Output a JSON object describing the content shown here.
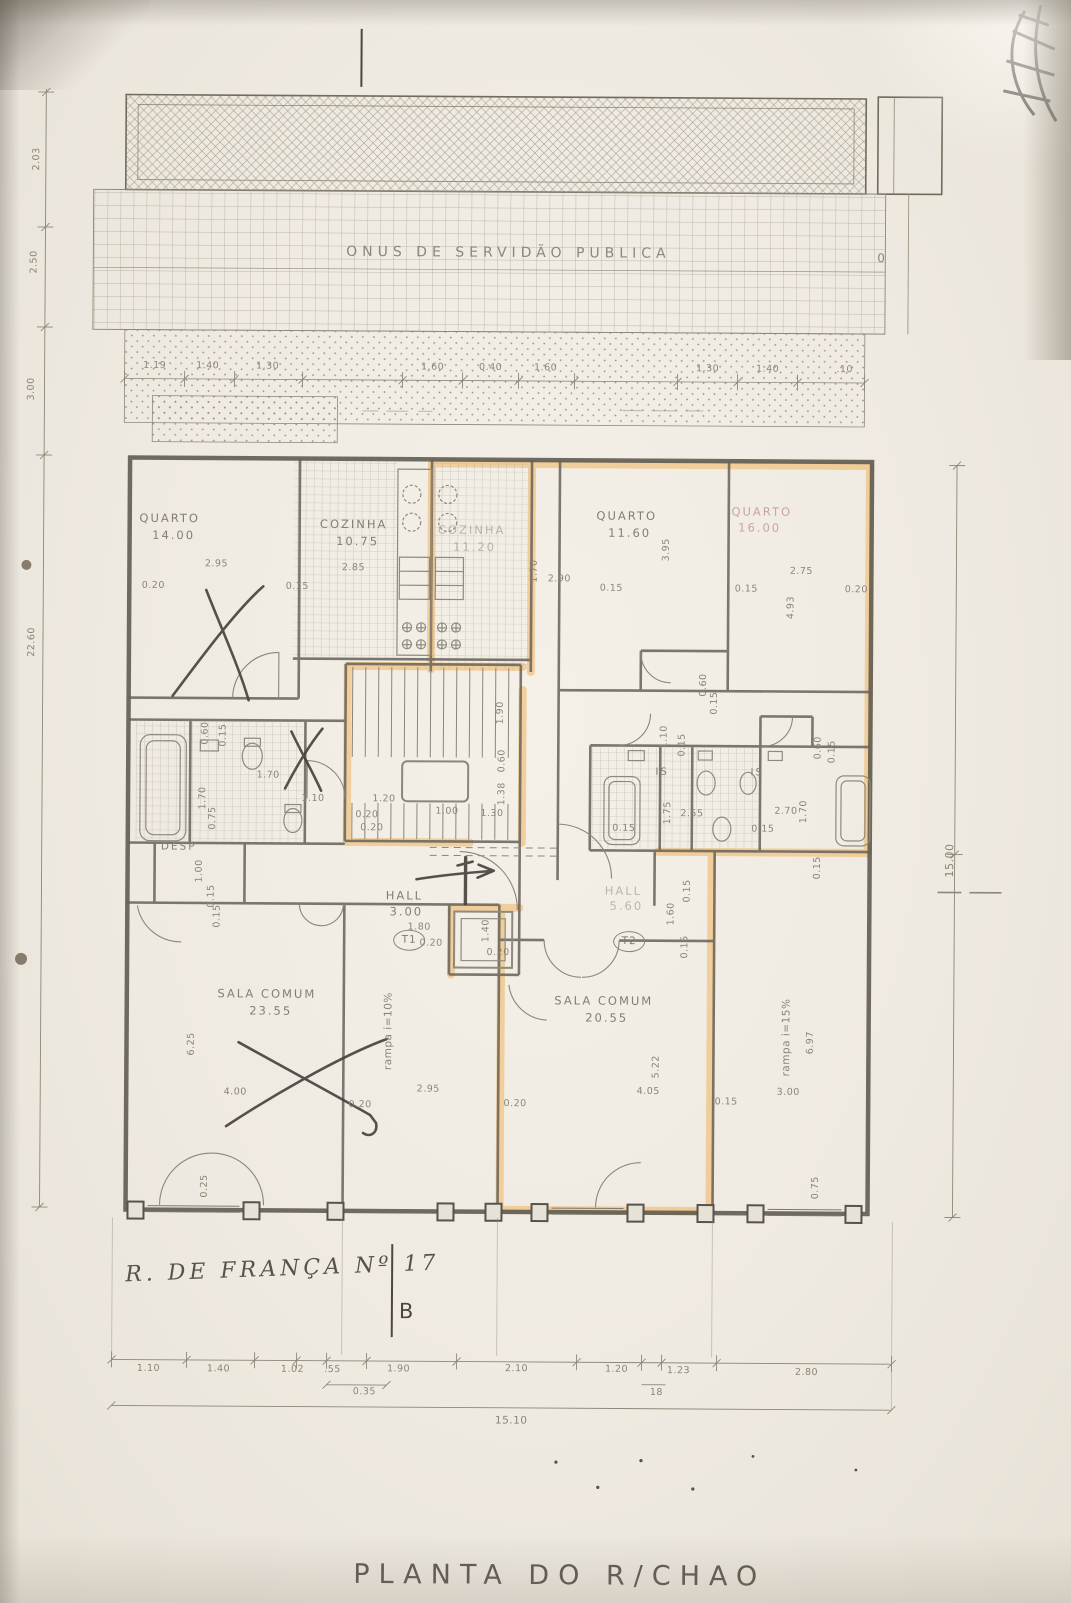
{
  "title": {
    "text": "PLANTA DO R/CHAO"
  },
  "marks": {
    "section": "B",
    "zero": "0",
    "address": "R. DE FRANÇA Nº 17"
  },
  "band": {
    "label": "ONUS DE SERVIDÃO PUBLICA"
  },
  "rooms": {
    "quarto_nw": {
      "name": "QUARTO",
      "area": "14.00"
    },
    "cozinha_1": {
      "name": "COZINHA",
      "area": "10.75"
    },
    "cozinha_2": {
      "name": "COZINHA",
      "area": "11.20"
    },
    "quarto_n": {
      "name": "QUARTO",
      "area": "11.60"
    },
    "quarto_ne": {
      "name": "QUARTO",
      "area": "16.00"
    },
    "desp": {
      "name": "DESP"
    },
    "hall_t1": {
      "name": "HALL",
      "area": "3.00"
    },
    "hall_t2": {
      "name": "HALL",
      "area": "5.60"
    },
    "is_1": {
      "name": "IS"
    },
    "is_2": {
      "name": "IS"
    },
    "sala_t1": {
      "name": "SALA COMUM",
      "area": "23.55"
    },
    "sala_t2": {
      "name": "SALA COMUM",
      "area": "20.55"
    }
  },
  "units": {
    "t1": "T1",
    "t2": "T2"
  },
  "ramps": {
    "left": "rampa  i=10%",
    "right": "rampa  i=15%"
  },
  "dims": {
    "left": [
      "2.03",
      "2.50",
      "3.00",
      "22.60"
    ],
    "right": [
      "15.00"
    ],
    "top": [
      "1.19",
      "1.40",
      "1.30",
      "1.60",
      "0.40",
      "1.60",
      "1.30",
      "1.40",
      ".10"
    ],
    "upper": [
      "0.20",
      "2.95",
      "0.15",
      "2.85",
      "1.70",
      "2.90",
      "0.15",
      "3.95",
      "0.15",
      "2.75",
      "4.93",
      "0.20"
    ],
    "mid": [
      "0.60",
      "0.15",
      "1.70",
      "1.70",
      "0.75",
      "1.10",
      "1.20",
      "0.20",
      "1.90",
      "0.60",
      "1.38",
      "1.00",
      "1.30",
      "0.20",
      "1.10",
      "0.15",
      "2.55",
      "1.75",
      "2.70",
      "1.70",
      "0.15",
      "0.15",
      "0.60",
      "0.15",
      "1.00",
      "0.15",
      "1.80",
      "0.20",
      "0.15",
      "1.60",
      "0.15",
      "1.40",
      "0.20",
      "0.60",
      "0.15"
    ],
    "lower": [
      "6.25",
      "4.00",
      "0.25",
      "0.15",
      "0.20",
      "2.95",
      "5.22",
      "4.05",
      "0.20",
      "0.15",
      "3.00",
      "6.97",
      "0.15",
      "0.75"
    ],
    "bottom": [
      "1.10",
      "1.40",
      "1.02",
      ".55",
      "1.90",
      "2.10",
      "1.20",
      "1.23",
      "2.80"
    ],
    "bottom_sub": [
      "0.35",
      "18"
    ],
    "total": "15.10"
  }
}
